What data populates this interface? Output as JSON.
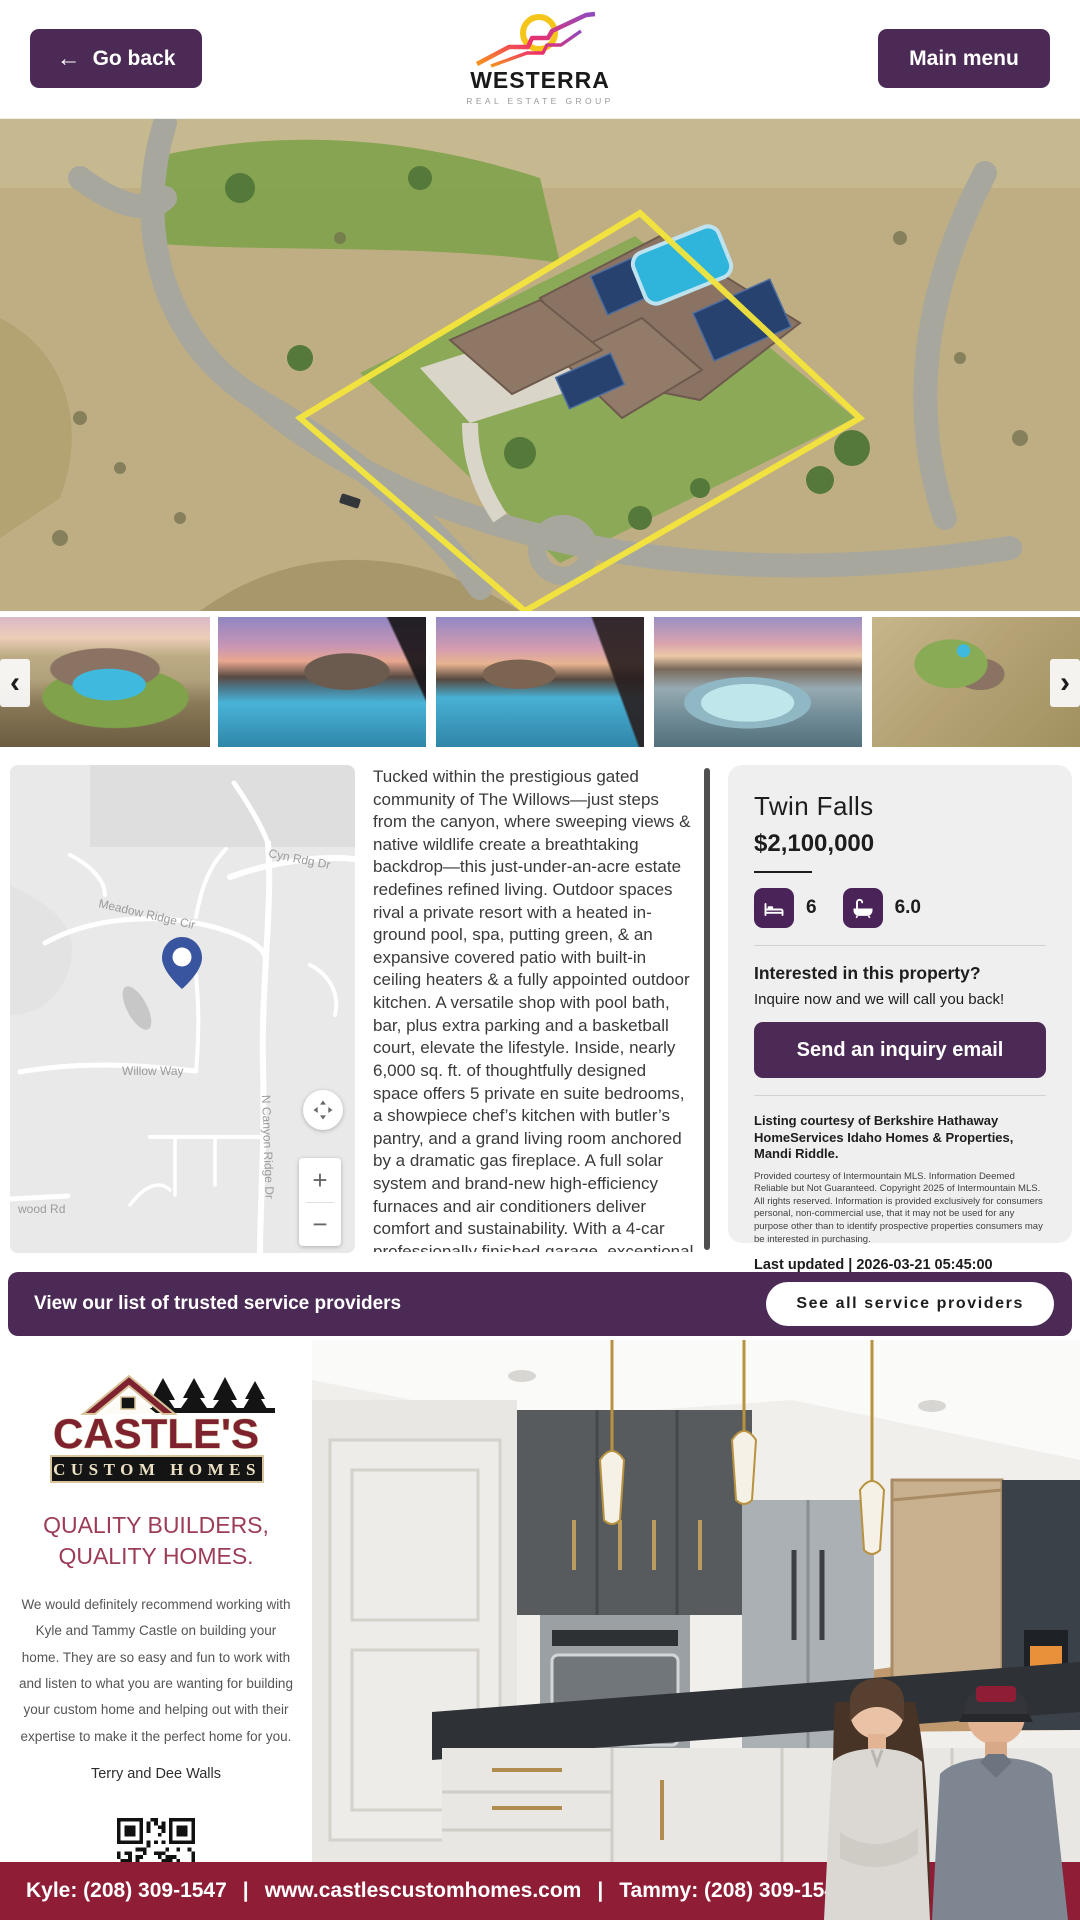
{
  "header": {
    "go_back_label": "Go back",
    "main_menu_label": "Main menu",
    "logo": {
      "name": "WESTERRA",
      "subtitle": "REAL ESTATE GROUP"
    }
  },
  "icons": {
    "back_arrow": "←",
    "prev": "‹",
    "next": "›"
  },
  "map": {
    "labels": [
      "Cyn Rdg Dr",
      "Meadow Ridge Cir",
      "Willow Way",
      "N Canyon Ridge Dr",
      "wood Rd"
    ],
    "zoom_in": "+",
    "zoom_out": "−"
  },
  "listing": {
    "city": "Twin Falls",
    "price": "$2,100,000",
    "beds": "6",
    "baths": "6.0",
    "description": "Tucked within the prestigious gated community of The Willows—just steps from the canyon, where sweeping views & native wildlife create a breathtaking backdrop—this just-under-an-acre estate redefines refined living. Outdoor spaces rival a private resort with a heated in-ground pool, spa, putting green, & an expansive covered patio with built-in ceiling heaters & a fully appointed outdoor kitchen. A versatile shop with pool bath, bar, plus extra parking and a basketball court, elevate the lifestyle. Inside, nearly 6,000 sq. ft. of thoughtfully designed space offers 5 private en suite bedrooms, a showpiece chef’s kitchen with butler’s pantry, and a grand living room anchored by a dramatic gas fireplace. A full solar system and brand-new high-efficiency furnaces and air conditioners deliver comfort and sustainability. With a 4-car professionally finished garage, exceptional storage, and access to the community’s shared horse pasture, this residence blends",
    "interested_heading": "Interested in this property?",
    "interested_sub": "Inquire now and we will call you back!",
    "inquiry_button": "Send an inquiry email",
    "courtesy": "Listing courtesy of Berkshire Hathaway HomeServices Idaho Homes & Properties, Mandi Riddle.",
    "disclaimer": "Provided courtesy of Intermountain MLS. Information Deemed Reliable but Not Guaranteed. Copyright 2025 of Intermountain MLS. All rights reserved. Information is provided exclusively for consumers personal, non-commercial use, that it may not be used for any purpose other than to identify prospective properties consumers may be interested in purchasing.",
    "last_updated": "Last updated | 2026-03-21 05:45:00"
  },
  "service_banner": {
    "text": "View our list of trusted service providers",
    "button": "See all service providers"
  },
  "sponsor": {
    "logo_line1": "CASTLE'S",
    "logo_line2": "CUSTOM HOMES",
    "tagline_line1": "QUALITY BUILDERS,",
    "tagline_line2": "QUALITY HOMES.",
    "testimonial": "We would definitely recommend working with Kyle and Tammy Castle on building your home. They are so easy and fun to work with and listen to what you are wanting for building your custom home and helping out with their expertise to make it the perfect home for you.",
    "attribution": "Terry and Dee Walls",
    "footer": {
      "kyle": "Kyle: (208) 309-1547",
      "separator": "|",
      "website": "www.castlescustomhomes.com",
      "tammy": "Tammy: (208) 309-1549"
    }
  },
  "colors": {
    "accent_purple": "#4b2a55",
    "sponsor_maroon": "#8e1d35",
    "castle_logo_maroon": "#7e2230",
    "map_pin_blue": "#3a559f",
    "boundary_yellow": "#f3e53c"
  }
}
